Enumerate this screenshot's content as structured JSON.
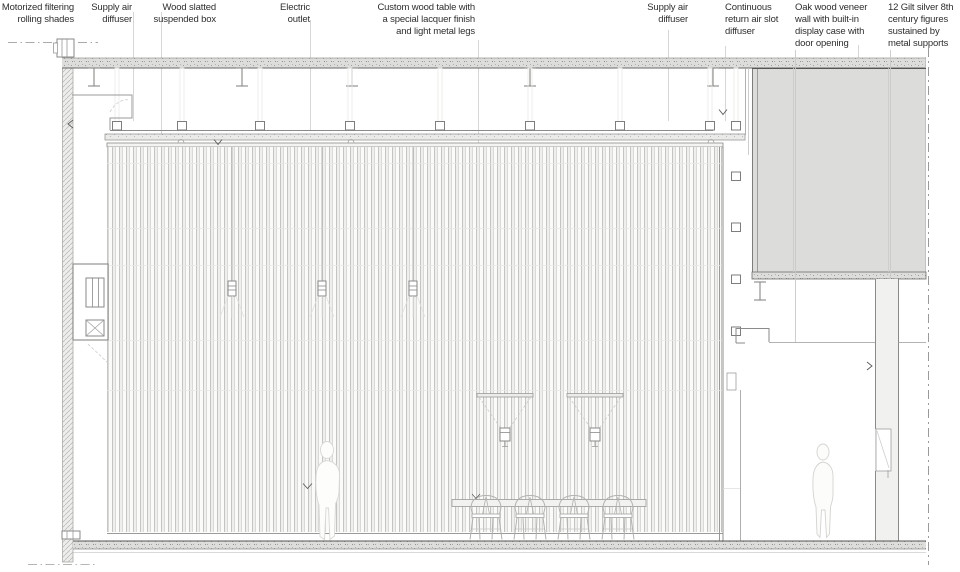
{
  "title": "Architectural section detail with annotations",
  "annotations": {
    "items": [
      {
        "id": "motorized-shades",
        "text": "Motorized filtering\nrolling shades"
      },
      {
        "id": "supply-air-diffuser-left",
        "text": "Supply air\ndiffuser"
      },
      {
        "id": "wood-slatted-box",
        "text": "Wood slatted\nsuspended box"
      },
      {
        "id": "electric-outlet",
        "text": "Electric\noutlet"
      },
      {
        "id": "custom-wood-table",
        "text": "Custom wood table with\na special lacquer finish\nand light metal legs"
      },
      {
        "id": "supply-air-diffuser-right",
        "text": "Supply air\ndiffuser"
      },
      {
        "id": "return-air-diffuser",
        "text": "Continuous\nreturn air slot\ndiffuser"
      },
      {
        "id": "oak-veneer-wall",
        "text": "Oak wood veneer\nwall with built-in\ndisplay case with\ndoor opening"
      },
      {
        "id": "gilt-figures",
        "text": "12 Gilt silver 8th\ncentury figures\nsustained by\nmetal supports"
      }
    ]
  },
  "drawing": {
    "elements": [
      {
        "id": "concrete-slab-icon"
      },
      {
        "id": "steel-beam-icon"
      },
      {
        "id": "suspended-ceiling-icon"
      },
      {
        "id": "air-diffuser-square-icon"
      },
      {
        "id": "wood-slat-wall-icon"
      },
      {
        "id": "pendant-light-icon"
      },
      {
        "id": "suspended-spotlight-icon"
      },
      {
        "id": "table-icon"
      },
      {
        "id": "wishbone-chair-icon"
      },
      {
        "id": "human-figure-icon"
      },
      {
        "id": "rolling-shade-unit-icon"
      },
      {
        "id": "return-air-slot-icon"
      },
      {
        "id": "display-wall-niche-icon"
      },
      {
        "id": "floor-slab-icon"
      },
      {
        "id": "section-cut-dashed-line-icon"
      }
    ]
  },
  "colors": {
    "background": "#ffffff",
    "slab_fill": "#dddddb",
    "gray_volume": "#dcdcda",
    "line_dark": "#555555",
    "line_mid": "#8f8f8f",
    "line_light": "#c6c6c6",
    "text": "#2e2e2e"
  }
}
